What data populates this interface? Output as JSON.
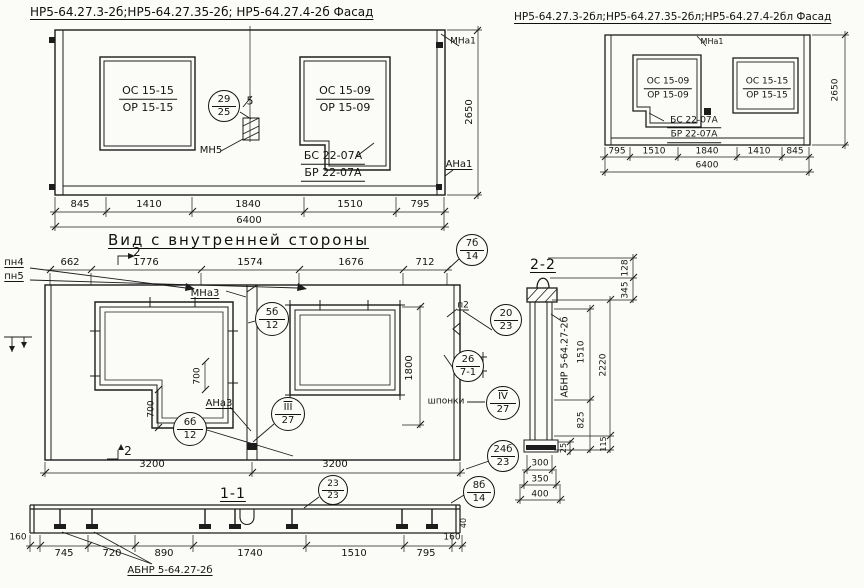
{
  "titles": {
    "facade_left": "НР5-64.27.3-2б;НР5-64.27.35-2б; НР5-64.27.4-2б Фасад",
    "facade_right": "НР5-64.27.3-2бл;НР5-64.27.35-2бл;НР5-64.27.4-2бл Фасад",
    "inner_view": "Вид с внутренней стороны",
    "section_2_2": "2-2",
    "section_1_1": "1-1"
  },
  "labels": [
    {
      "t": "МНа1",
      "x": 463,
      "y": 42,
      "fs": 9
    },
    {
      "t": "5",
      "x": 250,
      "y": 101,
      "fs": 11
    },
    {
      "t": "МН5",
      "x": 211,
      "y": 151,
      "fs": 10
    },
    {
      "t": "АНа1",
      "x": 459,
      "y": 165,
      "fs": 10,
      "ul": 1
    },
    {
      "t": "2650",
      "x": 470,
      "y": 112,
      "fs": 10,
      "rot": 1
    },
    {
      "t": "845",
      "x": 80,
      "y": 205,
      "fs": 10
    },
    {
      "t": "1410",
      "x": 149,
      "y": 205,
      "fs": 10
    },
    {
      "t": "1840",
      "x": 248,
      "y": 205,
      "fs": 10
    },
    {
      "t": "1510",
      "x": 350,
      "y": 205,
      "fs": 10
    },
    {
      "t": "795",
      "x": 420,
      "y": 205,
      "fs": 10
    },
    {
      "t": "6400",
      "x": 249,
      "y": 221,
      "fs": 10
    },
    {
      "t": "МНа1",
      "x": 712,
      "y": 42,
      "fs": 8
    },
    {
      "t": "2650",
      "x": 836,
      "y": 90,
      "fs": 9,
      "rot": 1
    },
    {
      "t": "795",
      "x": 617,
      "y": 152,
      "fs": 9
    },
    {
      "t": "1510",
      "x": 654,
      "y": 152,
      "fs": 9
    },
    {
      "t": "1840",
      "x": 707,
      "y": 152,
      "fs": 9
    },
    {
      "t": "1410",
      "x": 759,
      "y": 152,
      "fs": 9
    },
    {
      "t": "845",
      "x": 795,
      "y": 152,
      "fs": 9
    },
    {
      "t": "6400",
      "x": 707,
      "y": 166,
      "fs": 9
    },
    {
      "t": "пн4",
      "x": 14,
      "y": 263,
      "fs": 10,
      "ul": 1
    },
    {
      "t": "пн5",
      "x": 14,
      "y": 277,
      "fs": 10,
      "ul": 1
    },
    {
      "t": "662",
      "x": 70,
      "y": 263,
      "fs": 10
    },
    {
      "t": "1776",
      "x": 146,
      "y": 263,
      "fs": 10
    },
    {
      "t": "1574",
      "x": 250,
      "y": 263,
      "fs": 10
    },
    {
      "t": "1676",
      "x": 351,
      "y": 263,
      "fs": 10
    },
    {
      "t": "712",
      "x": 425,
      "y": 263,
      "fs": 10
    },
    {
      "t": "2",
      "x": 137,
      "y": 252,
      "fs": 12
    },
    {
      "t": "2",
      "x": 128,
      "y": 451,
      "fs": 12
    },
    {
      "t": "МНа3",
      "x": 205,
      "y": 294,
      "fs": 10,
      "ul": 1
    },
    {
      "t": "АНа3",
      "x": 219,
      "y": 404,
      "fs": 10,
      "ul": 1
    },
    {
      "t": "700",
      "x": 152,
      "y": 409,
      "fs": 9,
      "rot": 1
    },
    {
      "t": "700",
      "x": 198,
      "y": 376,
      "fs": 9,
      "rot": 1
    },
    {
      "t": "1800",
      "x": 410,
      "y": 368,
      "fs": 10,
      "rot": 1
    },
    {
      "t": "шпонки",
      "x": 446,
      "y": 402,
      "fs": 9
    },
    {
      "t": "п2",
      "x": 463,
      "y": 306,
      "fs": 9,
      "ul": 1
    },
    {
      "t": "3200",
      "x": 152,
      "y": 465,
      "fs": 10
    },
    {
      "t": "3200",
      "x": 335,
      "y": 465,
      "fs": 10
    },
    {
      "t": "АБНР 5-64.27-2б",
      "x": 565,
      "y": 357,
      "fs": 9.5,
      "rot": 1
    },
    {
      "t": "128",
      "x": 626,
      "y": 268,
      "fs": 9,
      "rot": 1
    },
    {
      "t": "345",
      "x": 626,
      "y": 290,
      "fs": 9,
      "rot": 1
    },
    {
      "t": "1510",
      "x": 582,
      "y": 352,
      "fs": 9,
      "rot": 1
    },
    {
      "t": "2220",
      "x": 604,
      "y": 365,
      "fs": 9,
      "rot": 1
    },
    {
      "t": "825",
      "x": 582,
      "y": 420,
      "fs": 9,
      "rot": 1
    },
    {
      "t": "25",
      "x": 564,
      "y": 448,
      "fs": 8,
      "rot": 1
    },
    {
      "t": "115",
      "x": 604,
      "y": 444,
      "fs": 8,
      "rot": 1
    },
    {
      "t": "300",
      "x": 540,
      "y": 464,
      "fs": 9
    },
    {
      "t": "350",
      "x": 540,
      "y": 480,
      "fs": 9
    },
    {
      "t": "400",
      "x": 540,
      "y": 495,
      "fs": 9
    },
    {
      "t": "160",
      "x": 18,
      "y": 538,
      "fs": 9
    },
    {
      "t": "745",
      "x": 64,
      "y": 554,
      "fs": 10
    },
    {
      "t": "720",
      "x": 112,
      "y": 554,
      "fs": 10
    },
    {
      "t": "890",
      "x": 164,
      "y": 554,
      "fs": 10
    },
    {
      "t": "1740",
      "x": 250,
      "y": 554,
      "fs": 10
    },
    {
      "t": "1510",
      "x": 354,
      "y": 554,
      "fs": 10
    },
    {
      "t": "795",
      "x": 426,
      "y": 554,
      "fs": 10
    },
    {
      "t": "160",
      "x": 452,
      "y": 538,
      "fs": 9
    },
    {
      "t": "40",
      "x": 464,
      "y": 523,
      "fs": 8,
      "rot": 1
    },
    {
      "t": "АБНР 5-64.27-2б",
      "x": 170,
      "y": 571,
      "fs": 10,
      "ul": 1
    }
  ],
  "fractions": [
    {
      "top": "ОС 15-15",
      "bottom": "ОР 15-15",
      "x": 148,
      "y": 99,
      "fs": 11
    },
    {
      "top": "ОС 15-09",
      "bottom": "ОР 15-09",
      "x": 345,
      "y": 99,
      "fs": 11
    },
    {
      "top": "БС 22-07А",
      "bottom": "БР 22-07А",
      "x": 333,
      "y": 165,
      "fs": 11,
      "both": 1
    },
    {
      "top": "ОС 15-09",
      "bottom": "ОР 15-09",
      "x": 668,
      "y": 89,
      "fs": 9
    },
    {
      "top": "ОС 15-15",
      "bottom": "ОР 15-15",
      "x": 767,
      "y": 89,
      "fs": 9
    },
    {
      "top": "БС 22-07А",
      "bottom": "БР 22-07А",
      "x": 694,
      "y": 129,
      "fs": 9,
      "both": 1
    }
  ],
  "circles": [
    {
      "top": "29",
      "bottom": "25",
      "x": 224,
      "y": 106,
      "r": 16
    },
    {
      "top": "7б",
      "bottom": "14",
      "x": 472,
      "y": 250,
      "r": 16
    },
    {
      "top": "5б",
      "bottom": "12",
      "x": 272,
      "y": 319,
      "r": 17
    },
    {
      "top": "20",
      "bottom": "23",
      "x": 506,
      "y": 320,
      "r": 16
    },
    {
      "top": "26",
      "bottom": "7-1",
      "x": 468,
      "y": 366,
      "r": 16
    },
    {
      "top": "III",
      "bottom": "27",
      "x": 288,
      "y": 414,
      "r": 17,
      "roman": 1
    },
    {
      "top": "IV",
      "bottom": "27",
      "x": 503,
      "y": 403,
      "r": 17,
      "roman": 1
    },
    {
      "top": "6б",
      "bottom": "12",
      "x": 190,
      "y": 429,
      "r": 17
    },
    {
      "top": "24б",
      "bottom": "23",
      "x": 503,
      "y": 456,
      "r": 16
    },
    {
      "top": "23",
      "bottom": "23",
      "x": 333,
      "y": 490,
      "r": 15
    },
    {
      "top": "8б",
      "bottom": "14",
      "x": 479,
      "y": 492,
      "r": 16
    }
  ]
}
